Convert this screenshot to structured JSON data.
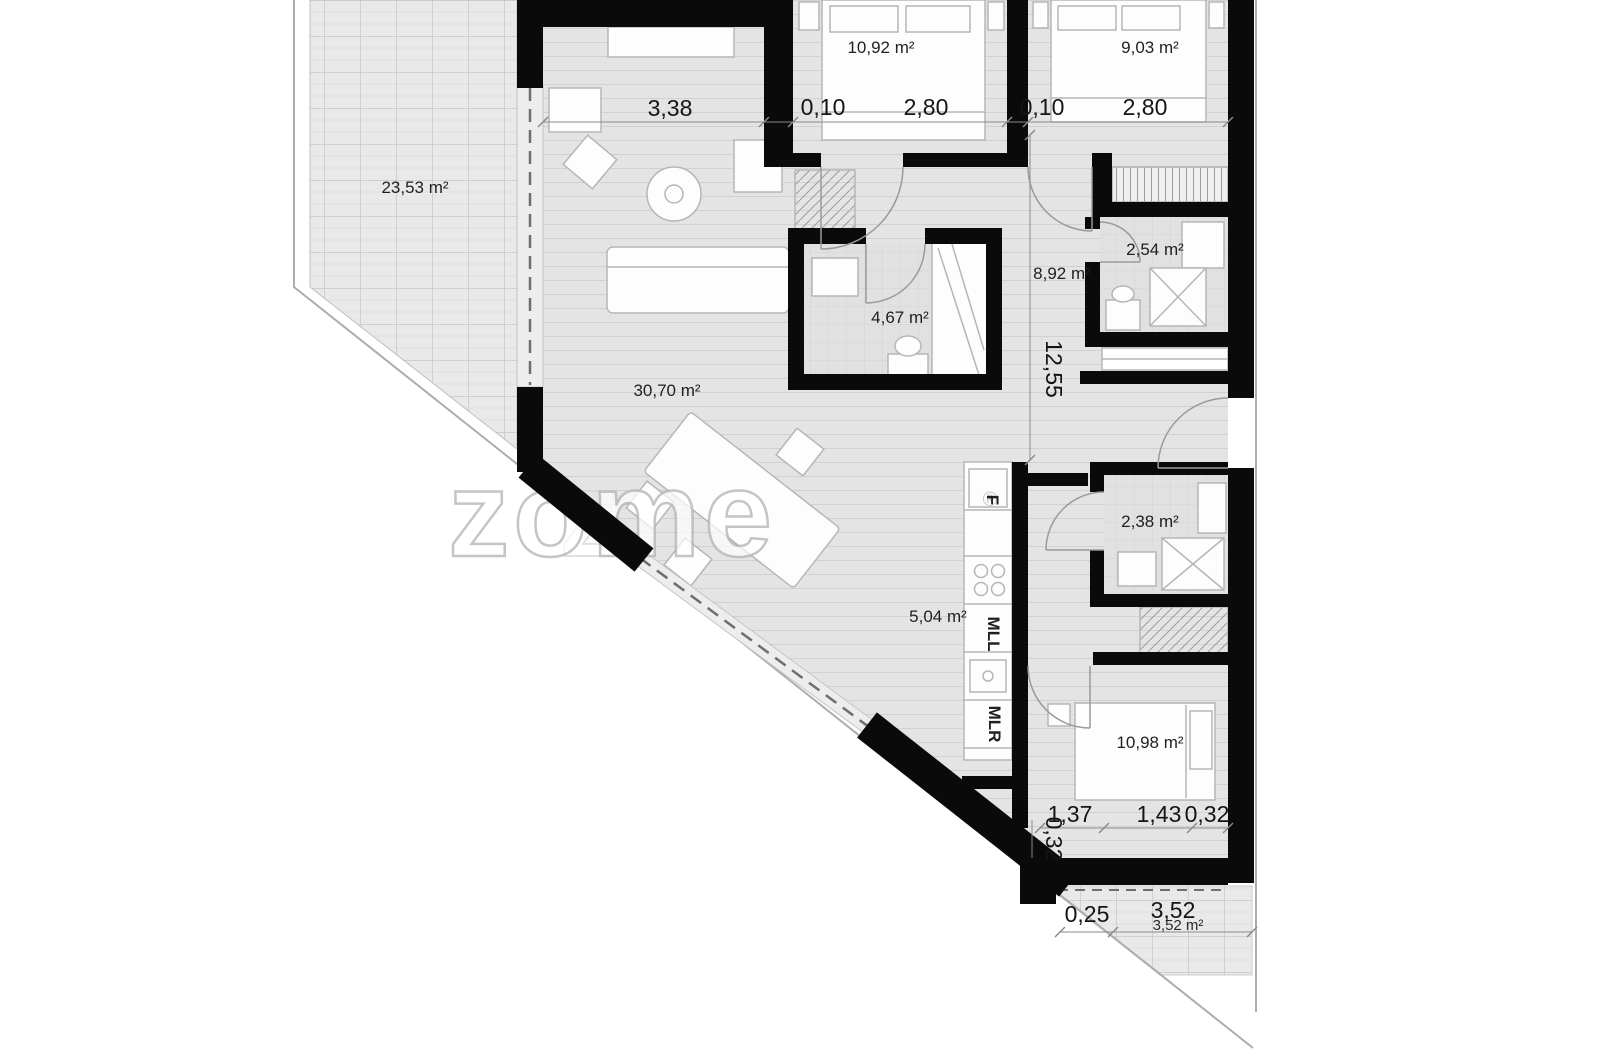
{
  "plan": {
    "watermark": "zome",
    "watermark_ghost": "z",
    "watermark_reg": "®",
    "rooms": {
      "terrace": "23,53 m²",
      "living": "30,70 m²",
      "bedroom_left": "10,92 m²",
      "bedroom_right": "9,03 m²",
      "bathroom_main": "4,67 m²",
      "bathroom_top": "2,54 m²",
      "hall": "8,92 m²",
      "kitchen": "5,04 m²",
      "bathroom_bottom": "2,38 m²",
      "bedroom_bottom": "10,98 m²",
      "terrace_bottom": "3,52 m²"
    },
    "dimensions": {
      "living_width": "3,38",
      "wall_left": "0,10",
      "bedroom_left_width": "2,80",
      "wall_mid": "0,10",
      "bedroom_right_width": "2,80",
      "depth_total": "12,55",
      "bedroom_bottom_a": "1,37",
      "bedroom_bottom_b": "1,43",
      "bedroom_bottom_c": "0,32",
      "bedroom_bottom_side": "0,32",
      "terrace_bottom_a": "0,25",
      "terrace_bottom_b": "3,52"
    },
    "kitchen": {
      "fridge": "F",
      "appliance_left": "MLL",
      "appliance_right": "MLR"
    }
  }
}
